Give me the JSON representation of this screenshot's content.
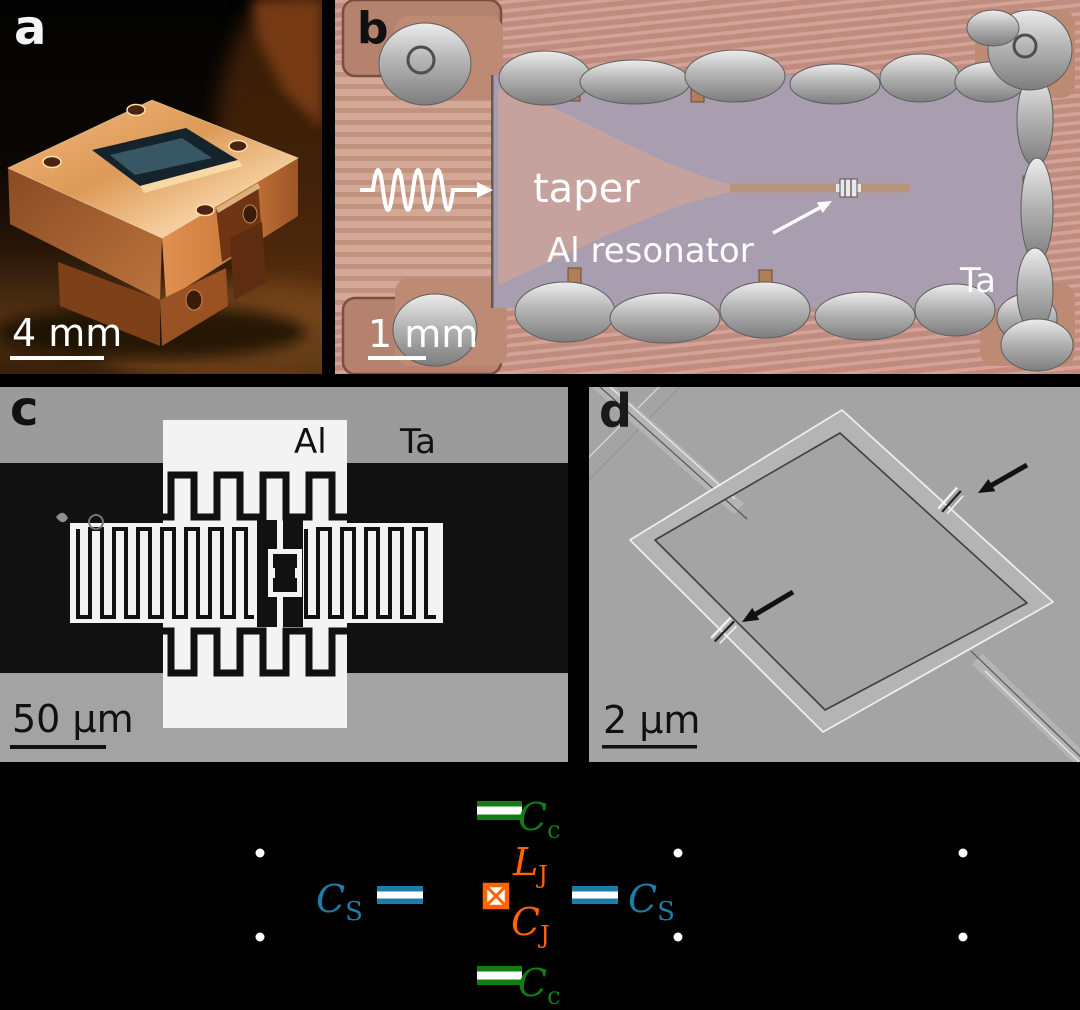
{
  "panel_a": {
    "label": "a",
    "scale_bar": "4 mm"
  },
  "panel_b": {
    "label": "b",
    "scale_bar": "1 mm",
    "taper_label": "taper",
    "resonator_label": "Al resonator",
    "material_label": "Ta"
  },
  "panel_c": {
    "label": "c",
    "material_al": "Al",
    "material_ta": "Ta",
    "scale_bar": "50 µm"
  },
  "panel_d": {
    "label": "d",
    "scale_bar": "2 µm"
  },
  "circuit": {
    "coupling_capacitor_top": {
      "main": "C",
      "sub": "c"
    },
    "coupling_capacitor_bottom": {
      "main": "C",
      "sub": "c"
    },
    "shunt_capacitor_left": {
      "main": "C",
      "sub": "S"
    },
    "shunt_capacitor_right": {
      "main": "C",
      "sub": "S"
    },
    "junction_inductance": {
      "main": "L",
      "sub": "J"
    },
    "junction_capacitance": {
      "main": "C",
      "sub": "J"
    },
    "colors": {
      "coupling_capacitor": "#0f7f13",
      "shunt_capacitor": "#1b7da8",
      "josephson_junction": "#ff6400",
      "node_dot": "#ffffff",
      "background": "#000000"
    }
  }
}
